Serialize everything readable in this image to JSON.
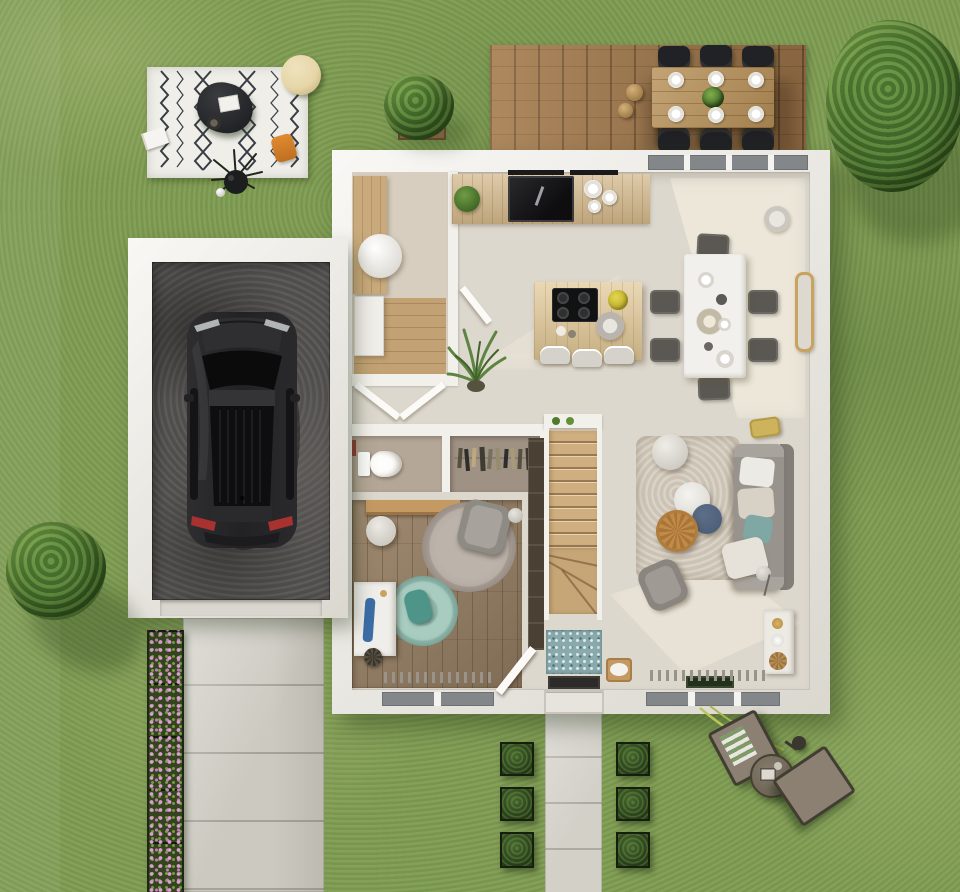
{
  "scene": {
    "label": "3D top-view render of a house ground-floor plan with garden, garage and terrace",
    "size": "960x892"
  },
  "labels": {
    "lawn": "lawn",
    "deck": "wooden terrace with outdoor dining set",
    "outdoor_table": "outdoor dining table for six",
    "picnic_rug": "black-and-white patterned outdoor rug",
    "garage": "garage",
    "car": "dark car parked in garage",
    "driveway": "paved driveway",
    "walkway": "front path with boxwood planters",
    "flower_bed": "flower border with pink blossoms",
    "lounge_set": "two garden loungers with round side table",
    "house": "house ground floor",
    "kitchen": "kitchen with island and wall counter",
    "dining": "dining area with white table",
    "living": "living room with corner sofa",
    "bedroom": "bedroom / study with round rugs",
    "wc": "toilet room",
    "closet": "wardrobe with hanging clothes",
    "utility": "utility room",
    "stairs": "wooden staircase with winder steps",
    "entry": "entrance hall with mosaic tile mat",
    "tree": "garden tree",
    "bush": "garden bush"
  },
  "counts": {
    "outdoor_dining_chairs": 6,
    "outdoor_plates": 6,
    "indoor_dining_chairs": 6,
    "island_stools": 3,
    "boxwood_planters": 6,
    "flower_bed_sections": 5,
    "living_coffee_tables": 3,
    "sun_loungers": 2,
    "trees": 1,
    "bushes": 2
  },
  "palette": {
    "grass_base": "#7e9b52",
    "tree_mid": "#5c8a3b",
    "tree_dark": "#456f2d",
    "wall": "#f2f0ea",
    "floor_main": "#ddd8ce",
    "floor_wood": "#937d64",
    "deck_wood": "#9c744a",
    "island_wood": "#dcc291",
    "counter_wood": "#cdb286",
    "stair_wood": "#cfae7f",
    "garage_floor": "#585654",
    "car_body": "#232325",
    "driveway": "#ccc9c0",
    "walkway": "#d3d0c8",
    "rug_white": "#efeee9",
    "rug_pattern": "#383d44",
    "flower_pink": "#d countless",
    "flower_pink_fixed": "#d99fce",
    "sofa_gray": "#98938c",
    "accent_teal": "#7fa7a3",
    "accent_blue_table": "#4d5e78",
    "accent_orange": "#e08a32",
    "pouf_cream": "#e6d6a8",
    "tile_blue": "#88aaad",
    "taillight_red": "#a83230"
  }
}
